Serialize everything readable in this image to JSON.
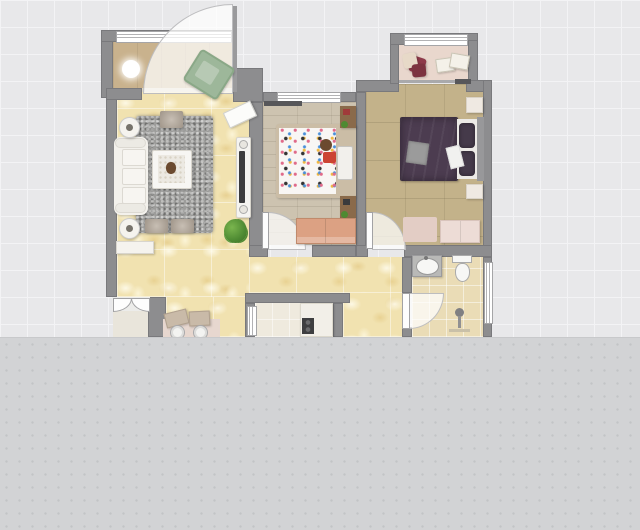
{
  "view": {
    "type": "floor-plan-2d-canvas",
    "width": 640,
    "height": 530
  },
  "rooms": [
    {
      "id": "entry-balcony"
    },
    {
      "id": "living-room"
    },
    {
      "id": "hallway"
    },
    {
      "id": "dining-nook"
    },
    {
      "id": "children-bedroom"
    },
    {
      "id": "master-bedroom"
    },
    {
      "id": "master-balcony"
    },
    {
      "id": "bathroom"
    },
    {
      "id": "kitchen"
    }
  ],
  "colors": {
    "canvas_grid": "#e8e8ea",
    "canvas_lower": "#d2d3d5",
    "wall": "#8d8d8f",
    "door_leaf_gray": "#9a9a9c",
    "door_white": "#fdfdfd",
    "arc_fill": "rgba(255,255,255,0.72)",
    "window_white": "#ffffff",
    "threshold": "#ddd6c4",
    "floor_entry": "#c9b28d",
    "floor_living": "#f1e2b0",
    "floor_child": "#cdc3b0",
    "floor_master": "#c3b28a",
    "floor_master_balcony": "#e9d7cd",
    "floor_bath": "#eadcb6",
    "floor_kitchen": "#efeade",
    "outside_pad": "#e9e5db",
    "mat_pink": "#e7d7cf",
    "rug_gray": "#9c9c9a",
    "sofa": "#f3f1ec",
    "cushion": "#f7f5f1",
    "coffee_table": "#f7f6f3",
    "table_inlay": "#ece9e2",
    "ottoman": "#b5a99b",
    "console_white": "#f5f3ee",
    "tv_console": "#f5f4f1",
    "tv_black": "#3c3c3e",
    "wall_art": "#fcfcfa",
    "plant_green": "#4e8a32",
    "lamp_white": "#ffffff",
    "chair_sage": "#9db79a",
    "chair_sage_seat": "#b7c9b4",
    "curtain_dark": "#57575a",
    "bed_frame_wood": "#cbbda6",
    "bed_white": "#f8f6f4",
    "pillow_white": "#f2f0ec",
    "teddy_brown": "#6b4a2f",
    "blanket_red": "#cc4433",
    "nightstand_wood": "#8a6a4a",
    "plant_pot_green": "#4e8a32",
    "dresser_salmon": "#dca183",
    "duvet_purple": "#4c3c50",
    "pillow_purple": "#453a4a",
    "mattress_white": "#eceae6",
    "headboard_gray": "#98989a",
    "blanket_gray": "#9b9b9b",
    "sheet_white": "#f1f1ef",
    "nightstand_cream": "#efe9e2",
    "rug_pink": "#e3cdc5",
    "dresser_pink": "#eddcd6",
    "pillow_red": "#8e3a4a",
    "pillow_cream": "#e7d9c8",
    "cushion_ivory": "#f4f1e9",
    "slider_gray": "#a9a9ab",
    "vanity_gray": "#b9b9b7",
    "fixture_white": "#f7f7f5",
    "shower_gray": "#808082",
    "drain_tan": "#c9c0a8",
    "counter_white": "#f2efe8",
    "cooktop_black": "#3e3e40",
    "desk_tan": "#c9baa8",
    "chair_white": "#f3f3f1"
  }
}
